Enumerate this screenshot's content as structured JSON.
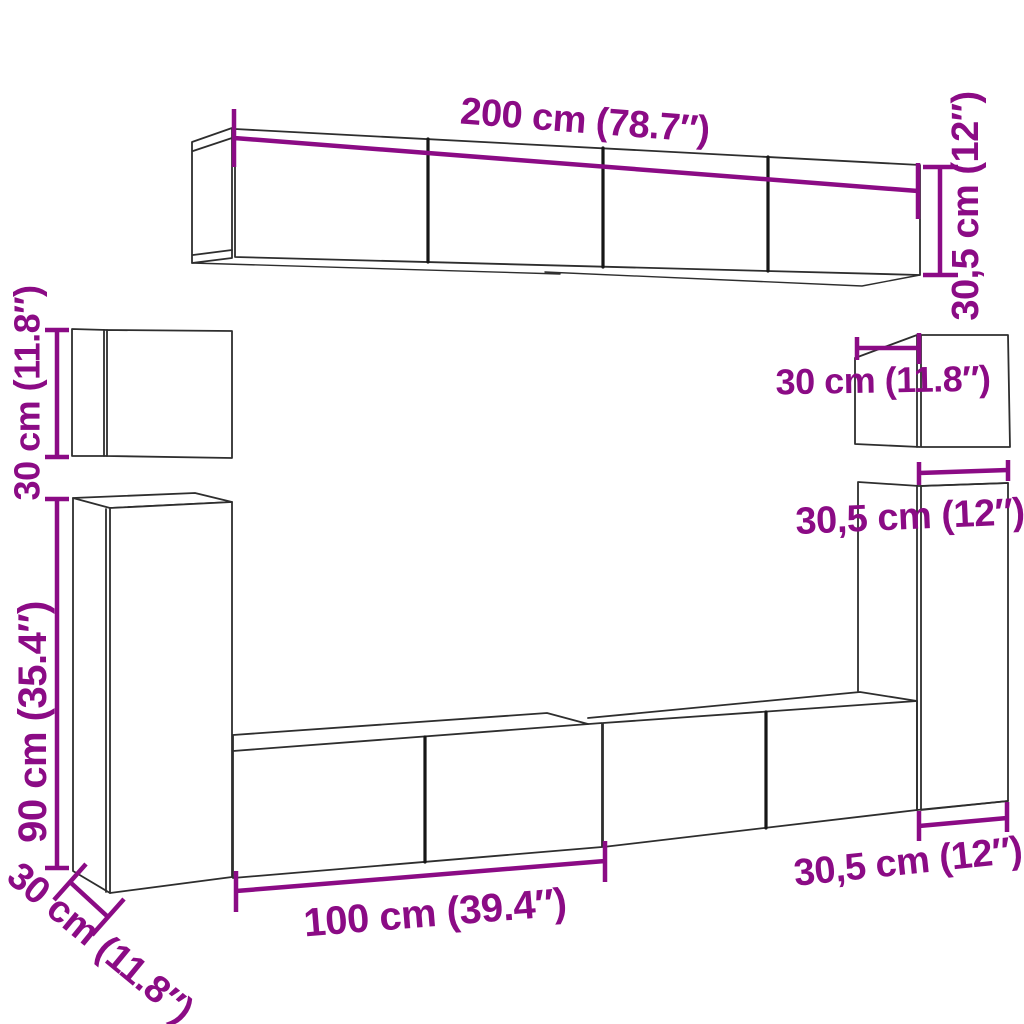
{
  "colors": {
    "background": "#ffffff",
    "outline": "#2e2e2e",
    "divider": "#161616",
    "dimension": "#8b0b85"
  },
  "dimensions": {
    "top_width": "200 cm (78.7″)",
    "top_height": "30,5 cm (12″)",
    "left_cube_height": "30 cm (11.8″)",
    "right_cube_depth": "30 cm (11.8″)",
    "right_column_width_top": "30,5 cm (12″)",
    "left_column_height": "90 cm (35.4″)",
    "left_column_depth": "30 cm (11.8″)",
    "bottom_width": "100 cm (39.4″)",
    "right_column_width_bottom": "30,5 cm (12″)"
  }
}
